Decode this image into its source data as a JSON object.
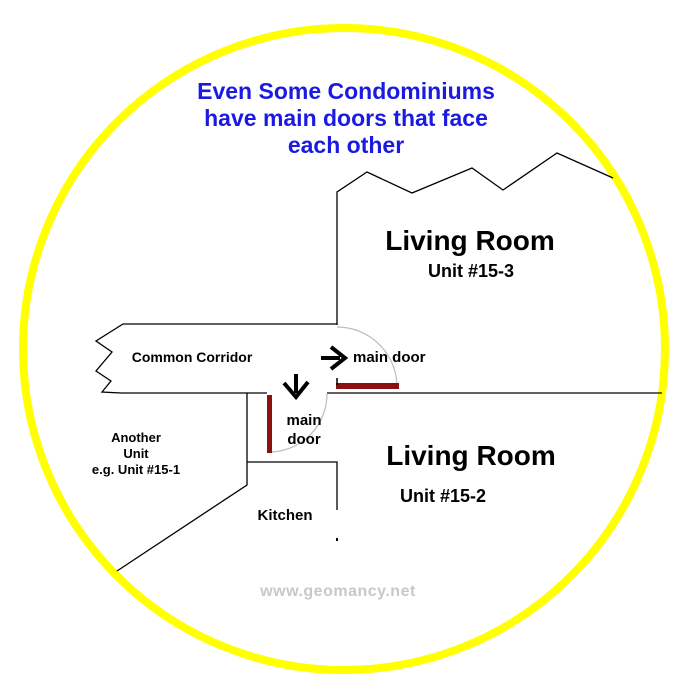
{
  "title": {
    "line1": "Even Some Condominiums",
    "line2": "have main doors that face",
    "line3": "each other"
  },
  "rooms": {
    "unit3": {
      "name": "Living Room",
      "unit": "Unit #15-3"
    },
    "unit2": {
      "name": "Living Room",
      "unit": "Unit #15-2"
    },
    "corridor": {
      "label": "Common Corridor"
    },
    "another_unit": {
      "line1": "Another",
      "line2": "Unit",
      "line3": "e.g. Unit #15-1"
    },
    "kitchen": {
      "label": "Kitchen"
    }
  },
  "doors": {
    "top_label": "main door",
    "bottom_label_line1": "main",
    "bottom_label_line2": "door"
  },
  "watermark": {
    "text": "www.geomancy.net"
  },
  "colors": {
    "title_blue": "#1A1AE0",
    "door_red": "#8B1111",
    "circle_yellow": "#FFFF00",
    "watermark_gray": "#C8C8C8",
    "wall_black": "#000000",
    "door_swing_gray": "#BBBBBB"
  }
}
